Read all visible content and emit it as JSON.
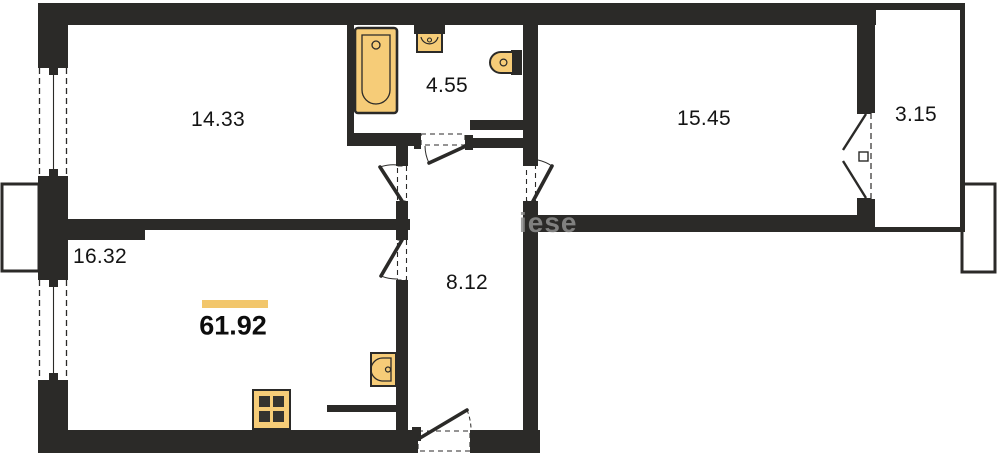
{
  "plan": {
    "watermark": "iese",
    "total": {
      "area": "61.92"
    },
    "rooms": [
      {
        "id": "room-top-left",
        "area": "14.33"
      },
      {
        "id": "bathroom",
        "area": "4.55"
      },
      {
        "id": "room-top-right",
        "area": "15.45"
      },
      {
        "id": "balcony",
        "area": "3.15"
      },
      {
        "id": "kitchen-living",
        "area": "16.32"
      },
      {
        "id": "hallway",
        "area": "8.12"
      }
    ],
    "colors": {
      "wall": "#2b2a28",
      "fixture_fill": "#f6cc78",
      "accent_bar": "#f2c66b",
      "watermark": "#8f8f8f"
    }
  }
}
